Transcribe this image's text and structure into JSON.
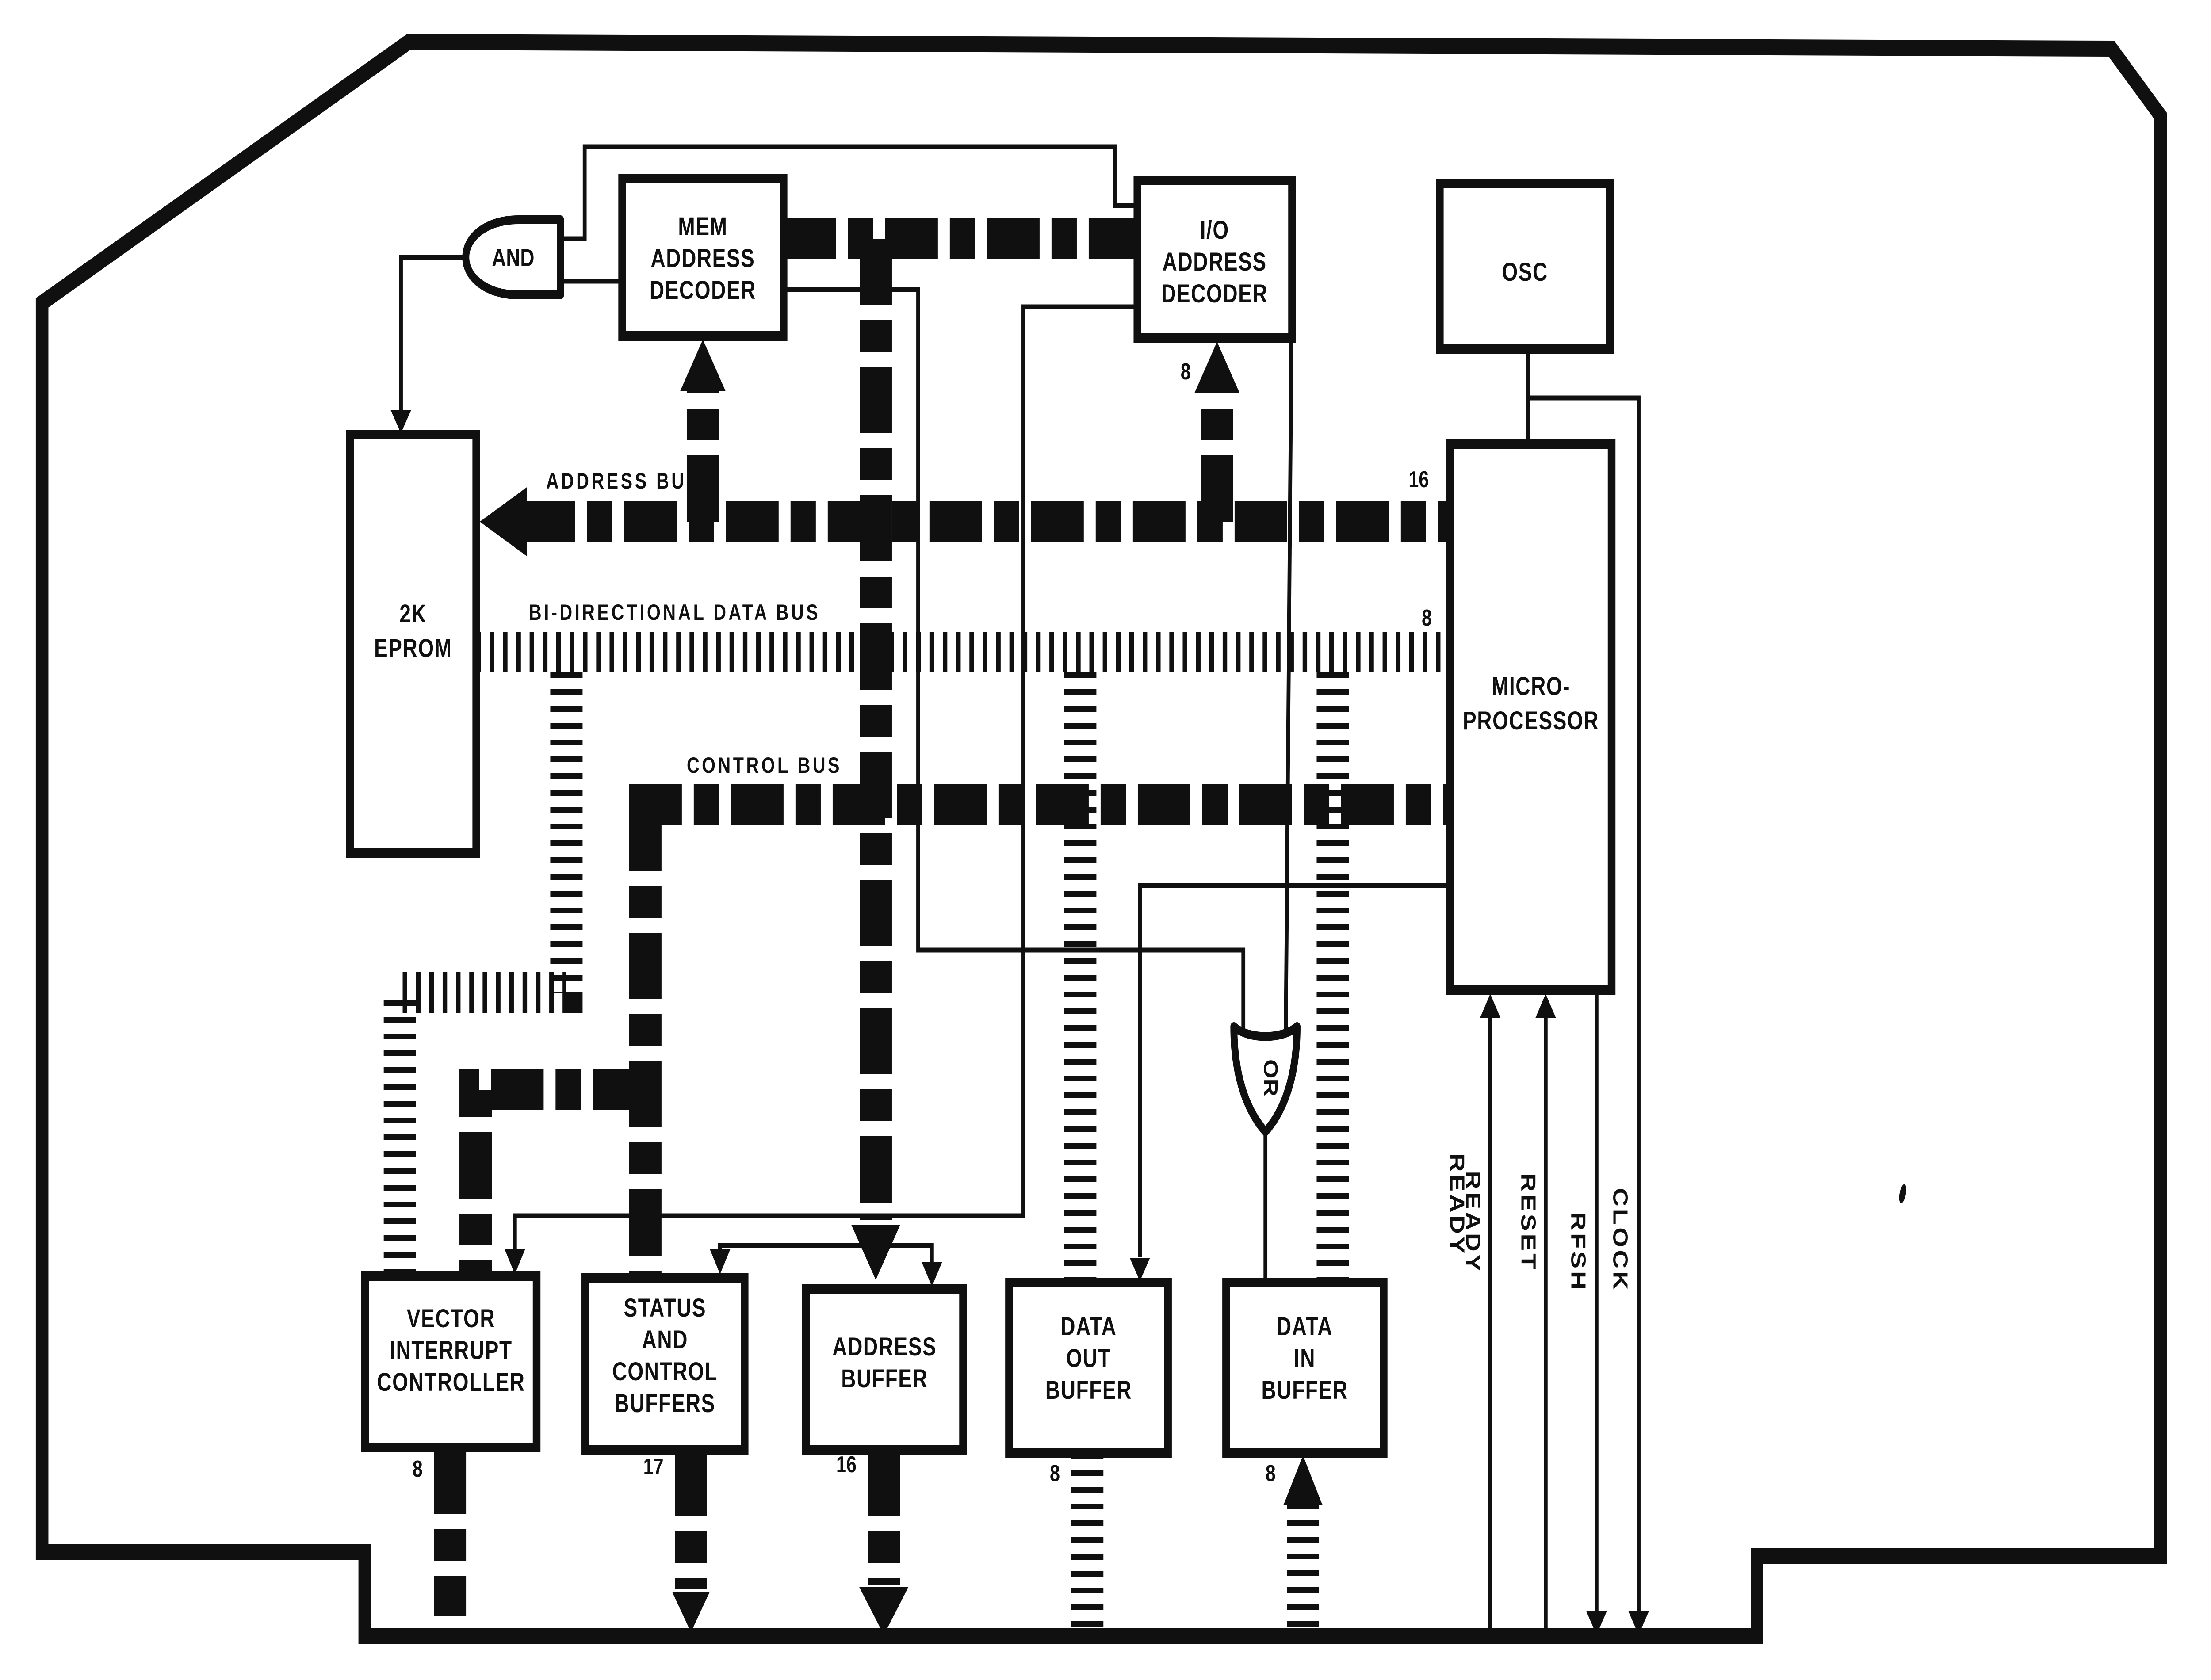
{
  "colors": {
    "ink": "#101010",
    "paper": "#ffffff"
  },
  "blocks": {
    "and_gate": "AND",
    "or_gate": "OR",
    "mem_decoder": {
      "line1": "MEM",
      "line2": "ADDRESS",
      "line3": "DECODER"
    },
    "io_decoder": {
      "line1": "I/O",
      "line2": "ADDRESS",
      "line3": "DECODER"
    },
    "osc": {
      "line1": "OSC"
    },
    "eprom": {
      "line1": "2K",
      "line2": "EPROM"
    },
    "microprocessor": {
      "line1": "MICRO-",
      "line2": "PROCESSOR"
    },
    "vector_interrupt_controller": {
      "line1": "VECTOR",
      "line2": "INTERRUPT",
      "line3": "CONTROLLER"
    },
    "status_control_buffers": {
      "line1": "STATUS",
      "line2": "AND",
      "line3": "CONTROL",
      "line4": "BUFFERS"
    },
    "address_buffer": {
      "line1": "ADDRESS",
      "line2": "BUFFER"
    },
    "data_out_buffer": {
      "line1": "DATA",
      "line2": "OUT",
      "line3": "BUFFER"
    },
    "data_in_buffer": {
      "line1": "DATA",
      "line2": "IN",
      "line3": "BUFFER"
    }
  },
  "bus_labels": {
    "address": "ADDRESS BUS",
    "data": "BI-DIRECTIONAL DATA BUS",
    "control": "CONTROL BUS"
  },
  "bus_widths": {
    "address_bus": "16",
    "data_bus": "8",
    "io_address": "8",
    "vector_out": "8",
    "status_out": "17",
    "address_out": "16",
    "data_out": "8",
    "data_in": "8"
  },
  "signal_labels": {
    "ready": "READY",
    "ready_ghost": "READY",
    "reset": "RESET",
    "rfsh": "RFSH",
    "clock": "CLOCK"
  }
}
